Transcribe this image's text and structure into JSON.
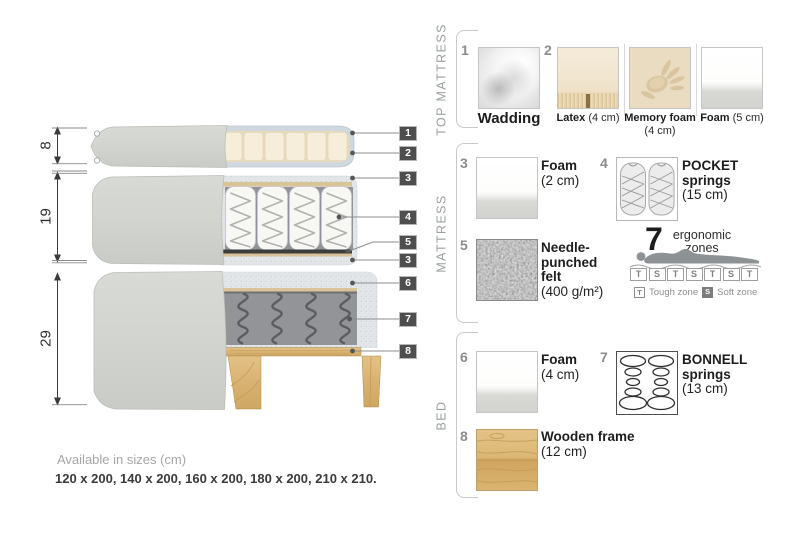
{
  "diagram": {
    "dimensions": [
      {
        "value": "8"
      },
      {
        "value": "19"
      },
      {
        "value": "29"
      }
    ],
    "callouts": [
      "1",
      "2",
      "3",
      "4",
      "5",
      "3",
      "6",
      "7",
      "8"
    ]
  },
  "legend": {
    "top_mattress": {
      "title": "TOP MATTRESS",
      "item1": {
        "num": "1",
        "caption": "Wadding"
      },
      "item2": {
        "num": "2",
        "latex": {
          "name": "Latex",
          "size": "(4 cm)"
        },
        "memory": {
          "name": "Memory foam",
          "size": "(4 cm)"
        },
        "foam": {
          "name": "Foam",
          "size": "(5 cm)"
        }
      }
    },
    "mattress": {
      "title": "MATTRESS",
      "foam2": {
        "num": "3",
        "name": "Foam",
        "size": "(2 cm)"
      },
      "pocket": {
        "num": "4",
        "name": "POCKET springs",
        "size": "(15 cm)"
      },
      "felt": {
        "num": "5",
        "name": "Needle-punched felt",
        "size": "(400 g/m²)"
      },
      "zones": {
        "count": "7",
        "label_line1": "ergonomic",
        "label_line2": "zones",
        "letters": [
          "T",
          "S",
          "T",
          "S",
          "T",
          "S",
          "T"
        ],
        "tough_key": "T",
        "tough_label": "Tough zone",
        "soft_key": "S",
        "soft_label": "Soft zone"
      }
    },
    "bed": {
      "title": "BED",
      "foam4": {
        "num": "6",
        "name": "Foam",
        "size": "(4 cm)"
      },
      "bonnell": {
        "num": "7",
        "name": "BONNELL springs",
        "size": "(13 cm)"
      },
      "frame": {
        "num": "8",
        "name": "Wooden frame",
        "size": "(12 cm)"
      }
    }
  },
  "footer": {
    "label": "Available in sizes (cm)",
    "sizes": "120 x 200, 140 x 200, 160 x 200, 180 x 200, 210 x 210."
  },
  "colors": {
    "callout_chip": "#4e4e4e",
    "fabric_grey": "#d3d6d0",
    "latex_cream": "#f5ecd9",
    "wadding_blue": "#cfd8df",
    "cutaway_speckle": "#e2e6e9",
    "wood": "#d8b272",
    "felt_dark": "#5a5a5a"
  }
}
